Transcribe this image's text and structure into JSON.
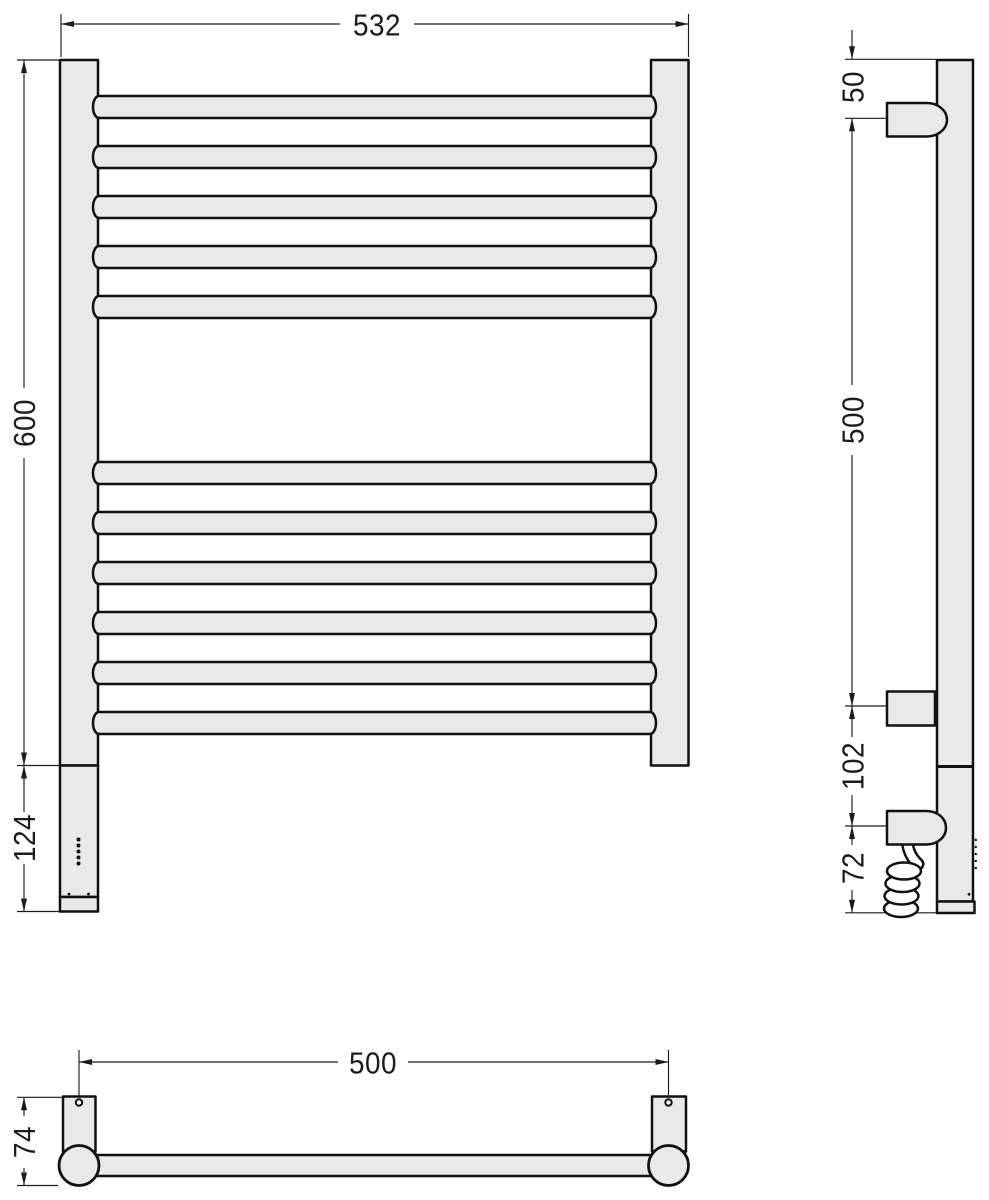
{
  "drawing": {
    "background_color": "#ffffff",
    "body_fill_color": "#e9e9e9",
    "outline_color": "#111111",
    "dimension_color": "#1c1c1c",
    "front_view": {
      "overall_width_label": "532",
      "overall_height_label": "600",
      "control_box_height_label": "124",
      "rung_count": 11,
      "rung_tops": [
        96,
        146,
        196,
        246,
        296,
        462,
        512,
        562,
        612,
        662,
        712
      ],
      "indicator_dot_count": 5
    },
    "side_view": {
      "top_bracket_offset_label": "50",
      "bracket_spacing_label": "500",
      "element_offset_label": "102",
      "cable_drop_label": "72"
    },
    "bottom_view": {
      "bracket_spacing_label": "500",
      "depth_label": "74"
    }
  }
}
